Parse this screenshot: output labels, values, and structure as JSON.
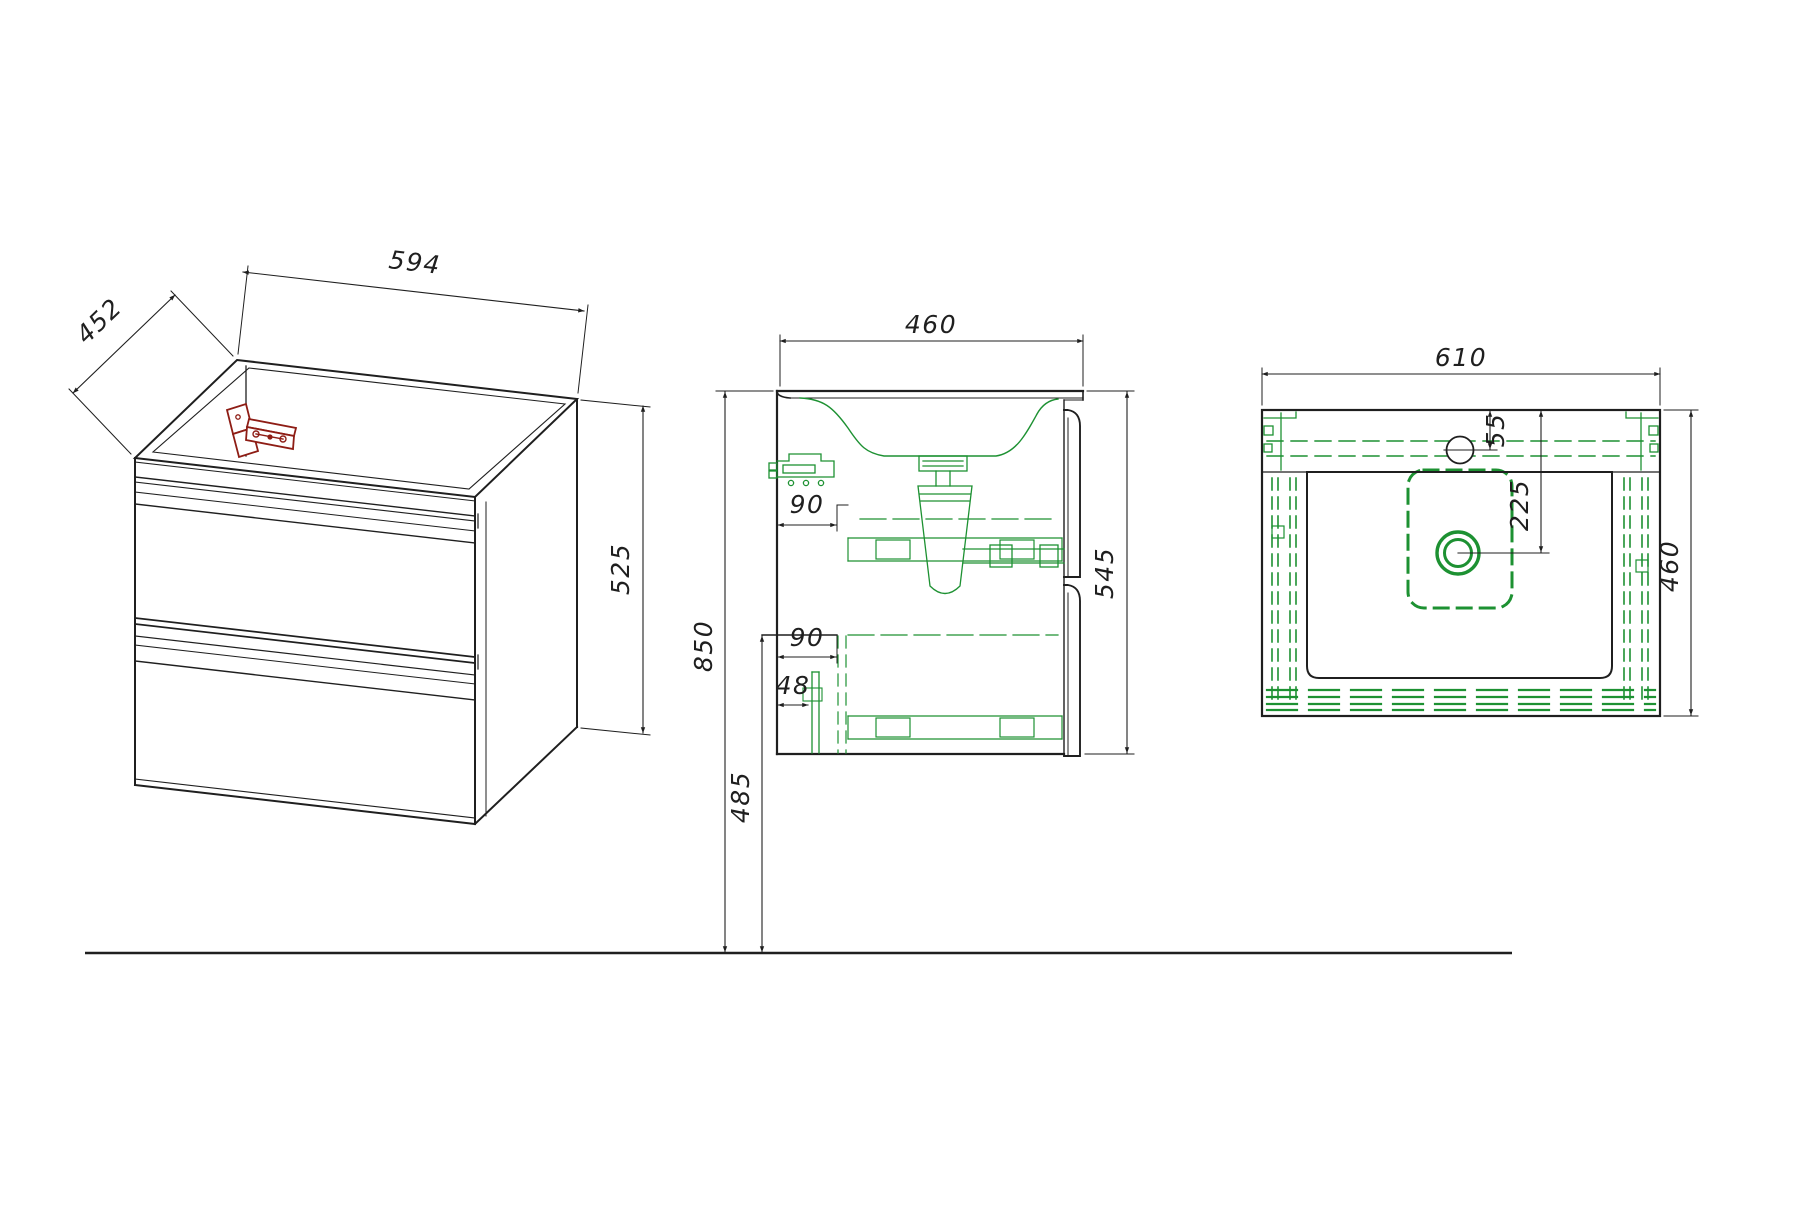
{
  "meta": {
    "title": "Vanity cabinet technical drawing",
    "drawing_type": "three-view furniture dimension drawing",
    "units": "mm"
  },
  "colors": {
    "outline_black": "#1f1f1f",
    "fittings_green": "#1d9132",
    "bracket_red": "#8e1d15",
    "background": "#ffffff"
  },
  "views": {
    "isometric": {
      "label": "isometric cabinet view",
      "dims": {
        "width": "594",
        "depth": "452",
        "height": "525"
      }
    },
    "section": {
      "label": "side section view",
      "dims": {
        "depth": "460",
        "height": "545",
        "floor_to_top": "850",
        "floor_to_drain": "485",
        "rail_offset_upper": "90",
        "rail_offset_lower": "90",
        "pipe_offset": "48"
      }
    },
    "top": {
      "label": "top view of washbasin",
      "dims": {
        "width": "610",
        "depth": "460",
        "faucet_to_back": "55",
        "drain_to_back": "225"
      }
    }
  }
}
